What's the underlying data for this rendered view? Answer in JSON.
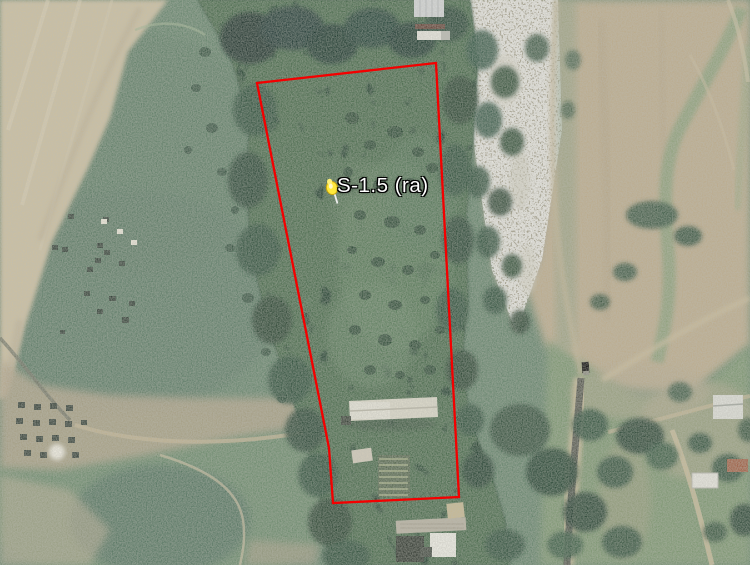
{
  "map": {
    "placemark": {
      "label": "S-1.5 (ra)",
      "pin_color": "#ffe93c",
      "pin_transform": "translate(332,188)"
    },
    "boundary": {
      "points": "257,83 436,63 459,497 333,503 329,448",
      "color": "#f40000",
      "stroke_width": "2.3"
    },
    "palette": {
      "field_green": "#62826a",
      "field_tan": "#cdc0a0",
      "forest_dark": "#24432f",
      "gravel_wash": "#a6a18e",
      "right_field_tan": "#bcab8b",
      "road_tan": "#ccbd9c",
      "road_asphalt": "#53554c",
      "label_text": "#ffffff"
    }
  }
}
